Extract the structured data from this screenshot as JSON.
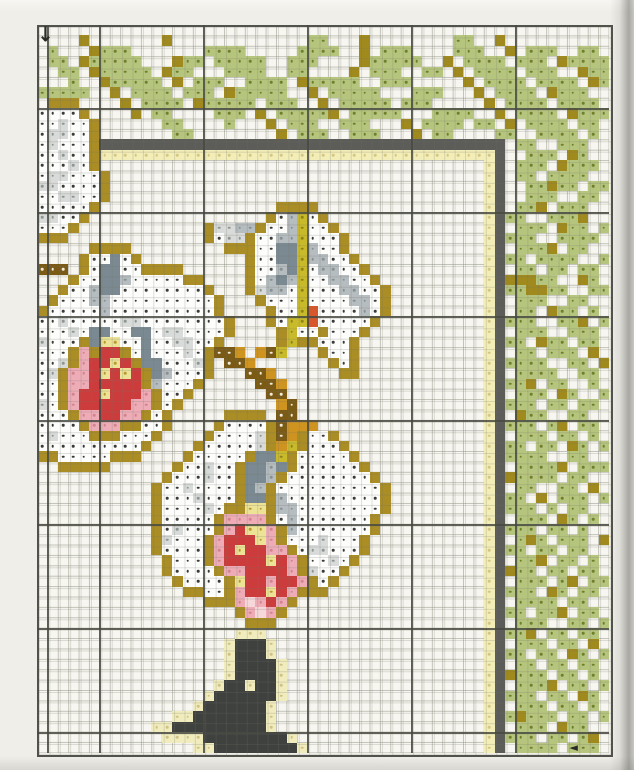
{
  "document": {
    "kind": "cross-stitch-pattern-chart",
    "subject": "white orchids with bamboo leaf border and bird silhouette"
  },
  "markers": {
    "down_arrow_glyph": "↓",
    "left_arrow_glyph": "◄",
    "down_arrow": {
      "col": 0,
      "row": 0
    },
    "left_arrow": {
      "col": 51,
      "row": 69
    }
  },
  "grid": {
    "cell_size": 10.4,
    "origin_x": 37,
    "origin_y": 25,
    "cols": 55,
    "rows": 70,
    "major_col_boundaries": [
      1,
      6,
      16,
      26,
      36,
      46
    ],
    "major_row_boundaries": [
      8,
      18,
      28,
      38,
      48,
      58,
      68
    ]
  },
  "legend": {
    "g": "leaf-green-stitch",
    "o": "olive-stem-stitch",
    "K": "dark-frame-line-stitch",
    "y": "pale-yellow-accent-stitch",
    "W": "white-petal-stitch",
    "l": "light-gray-petal-stitch",
    "m": "mid-gray-petal-stitch",
    "d": "slate-gray-shadow-stitch",
    "Y": "gold-outline-stitch",
    "b": "brown-stem-stitch",
    "c": "ochre-stem-stitch",
    "s": "yellow-green-stalk-stitch",
    "r": "red-center-stitch",
    "R": "orange-red-stitch",
    "p": "pink-center-stitch",
    "P": "pale-pink-stitch",
    "f": "yellow-center-stitch",
    "k": "charcoal-bird-stitch",
    "h": "pale-yellow-halo-stitch"
  },
  "palette": {
    "g": {
      "fill": "#b6c57d",
      "dot": "#6f7f2c"
    },
    "o": {
      "fill": "#a08a1e",
      "dot": null
    },
    "K": {
      "fill": "#5c5c59",
      "dot": null
    },
    "y": {
      "fill": "#f3edb7",
      "dot": "#d3c783"
    },
    "W": {
      "fill": "#fdfdfc",
      "dot": "#3a3a38"
    },
    "l": {
      "fill": "#d8dbd9",
      "dot": "#8f9694"
    },
    "m": {
      "fill": "#b6bdc0",
      "dot": "#879093"
    },
    "d": {
      "fill": "#7b8a92",
      "dot": null
    },
    "Y": {
      "fill": "#aa8d25",
      "dot": null
    },
    "b": {
      "fill": "#7a5a15",
      "dot": "#f0ead8"
    },
    "c": {
      "fill": "#cf9420",
      "dot": null
    },
    "s": {
      "fill": "#c9ba2b",
      "dot": "#8e8418"
    },
    "r": {
      "fill": "#cd3c3c",
      "dot": null
    },
    "R": {
      "fill": "#d8572b",
      "dot": null
    },
    "p": {
      "fill": "#eeacb7",
      "dot": "#d3848f"
    },
    "P": {
      "fill": "#f6d7da",
      "dot": null
    },
    "f": {
      "fill": "#ece396",
      "dot": "#b89a30"
    },
    "k": {
      "fill": "#3f413f",
      "dot": null
    },
    "h": {
      "fill": "#f1ecbe",
      "dot": "#cfc384"
    }
  },
  "pattern": {
    "rows": [
      ".......................................................",
      "....o.......o.............gg...o........gg..o..........",
      ".g...oggg.......gggg.....gggg..o.ggg....ggg..o.ggg..gg.",
      ".gg.oggggg...ogg.ggggg..ggg....oggggg..o.gggg.ggg.ogggg",
      "..gg.oggggg.ogg...gggg..gg....o.ggg..gg.o.gggg.ggg..ogg",
      "...g..oggggg.o.ggg..gggg.oggggg..ggg.....o.gggg.gggg.og",
      "ggggg..o.gggg.ggg.oggggg..o.ggggg...ggg...o.gggg.oggg..",
      ".YYY....o.gggg.oggggg.ggg..o.ggggg.ggg.....o.gggg.gggg.",
      "WWWWY....o.gg....ggg.o.gggggo.ggggg...gggg..o.gggg.oggg",
      "WWlWWY......gg....g...o.ggg..ggg...o.gggg.gg.o.gggg.gg.",
      "WllWWY.......gg........o.ggg..ggg...o.gg....gg..gggg.g.",
      "WlWWWYKKKKKKKKKKKKKKKKKKKKKKKKKKKKKKKKKKKKKKK.gg..ggg..",
      "WWlWWYyyyyyyyyyyyyyyyyyyyyyyyyyyyyyyyyyyyyyyK..ggg.og..",
      "WWWlWY.....................................yK.ggg.oggg.",
      "WllWWWY....................................yK.gg.gggg..",
      "llWWWWY....................................yK..ggogg.gg",
      "WWllWWY....................................yK..ggg..gg.",
      "WWWWWY.................YYYY................yK.ggo.ggg..",
      "llWWY.................YWmsWY...............yKgg..gggo..",
      "WWWY............YllmmYWWmsWWY..............yK.ggg.ogg.g",
      "YYY.............YWllYWWmmsWWWY.............yKggg..gggg.",
      ".....YYYY.........YYYWWddsmWWY.............yK.gggo.gg..",
      "....YWWdWY..........YWWddsmmWWY............yKgg.gggg..g",
      "bbb.YWddWWYYYY......YWWmdsWmmWWY...........yK.gg.gg.gg.",
      "...YWWddmWWWWWYY....YWmdmsWWmmWWY..........yKooogg..og.",
      "..YWWmddWWWWWWWWY...YlmmWsWWWmmWWY.........yKggoogg..gg",
      ".YWWWmmWWWWWWWWWWY...YWWWsWWWWmmWY.........yK.ggg..gg..",
      "YWWWWWmWWWWWWWWWWY....YWWsRWWWWmWY.........yK.gg.ogg.g.",
      "WWlWWWWWllWWWWWWWWY...YWssRWWWWWY..........yKggg..ggo.g",
      "WWWlWddWWddWllWWWWY....YsWWYWWWY...........yK.ggg..ggg.",
      "lWWWYdffWWdWWllWWY.....YsYYWWWY............yKgg.ogg.gg.",
      "WWWYpYrrYWdWWWlWYbbc.cbs...YWWY............yK.gg.ggg.o.",
      "WWlYprrfrYddWWWlY.bbc.......YWY............yKgggg..gg.o",
      "WlYpprfrfrYdmWWWY...bbc......YY............yK.gggg..gg.",
      "WWYpprrrrrYmWWWY.....bbc...................yKggo.gg..g.",
      "WWYprrfrrrpYWWY.......bb...................yK.ggg.og..g",
      "lWYprrrrrppYWY.........cb..................yKggg.gg.gg.",
      "WWWYpprrppYWY.....YYYY.bb..................yK.ogg..gg..",
      "WWWWYpppYYWWY....YWWWWYbccc................yKggg.go.gg.",
      "WlWWWYYYWWWY....YWWWWlYbcYWWY..............yK.ggg.gg.g.",
      "WWWWWWWWWWY....YWWWWWlYcsYWWWY.............yKgg.gg.og.g",
      "YYWWWWWYYY....YWWWWWYddsYWWWWWY............yKgggg..gg..",
      "..YYYYY......YWWlWWYddmdYWWWWWWY...........yK.ggggo.ggg",
      "............YWWWlWWYddmYWWWWWWWWY..........yKogggg.gg..",
      "...........YWWlWWWWYdmYWWWWWWWWWWY.........yK.gg..gg.o.",
      "...........YWWWlWWWYddYmWWWWWWWWWY.........yKgg.o.ggg.g",
      "...........YWWWWlWYYffYmmWWWWWWWWY.........yKggg.g.gg..",
      "...........YWWWWWYppppYWmWWWWWWWY..........yK.ggg.og.g.",
      "...........YWlWWWYprffpYmWWWWWWWY..........yKggg.gg.g..",
      "...........YlWWWYprrrfpYWWWlWWWY...........yK.gog.ggg.o",
      "...........YWWWWYprfrrppYWllWWWY...........yKgg.gg.gg..",
      "............YWWWYprrrrfrpYWWlWY............yK.ggo.gg.g.",
      "............YWWWWYpprrrrpYlWWY.............yKogg.gg.gg.",
      ".............YWWWWYfrrprrpYWY..............yK.ggg.go.gg",
      "..............YYWWYprrfrpYYY...............yKggg.og.gg.",
      "................YYYpPprpY..................yK.gggg.gg..",
      "...................YpPpY...................yKgg.ggo.gg.",
      "....................YYY....................yK.ggg..gg.g",
      "...................hhh.....................yKggo.gg.gg.",
      "..................hkkkh....................yK.ggg.gg.o.",
      "..................hkkkh....................yKgg.gg.og.g",
      "..................hkkkkh...................yK.gg.gg.gg.",
      "..................hkkkkh...................yKoggg.gg.g.",
      ".................hkkhkkh...................yK.gggo.gg.g",
      "................hkkkkkkh...................yKggg.gg.og.",
      "...............hkkkkkkh....................yK.ggg.gg.g.",
      ".............hhkkkkkkkh....................yKgoggg.gg.g",
      "...........hhkkkkkkkkkh....................yK.ggg.ogg..",
      "............hhhhkkkkkkkkh..................yKggg.gg.go.",
      "...............hhkkkkkkkkh.................yK.gggg.ggg."
    ]
  }
}
